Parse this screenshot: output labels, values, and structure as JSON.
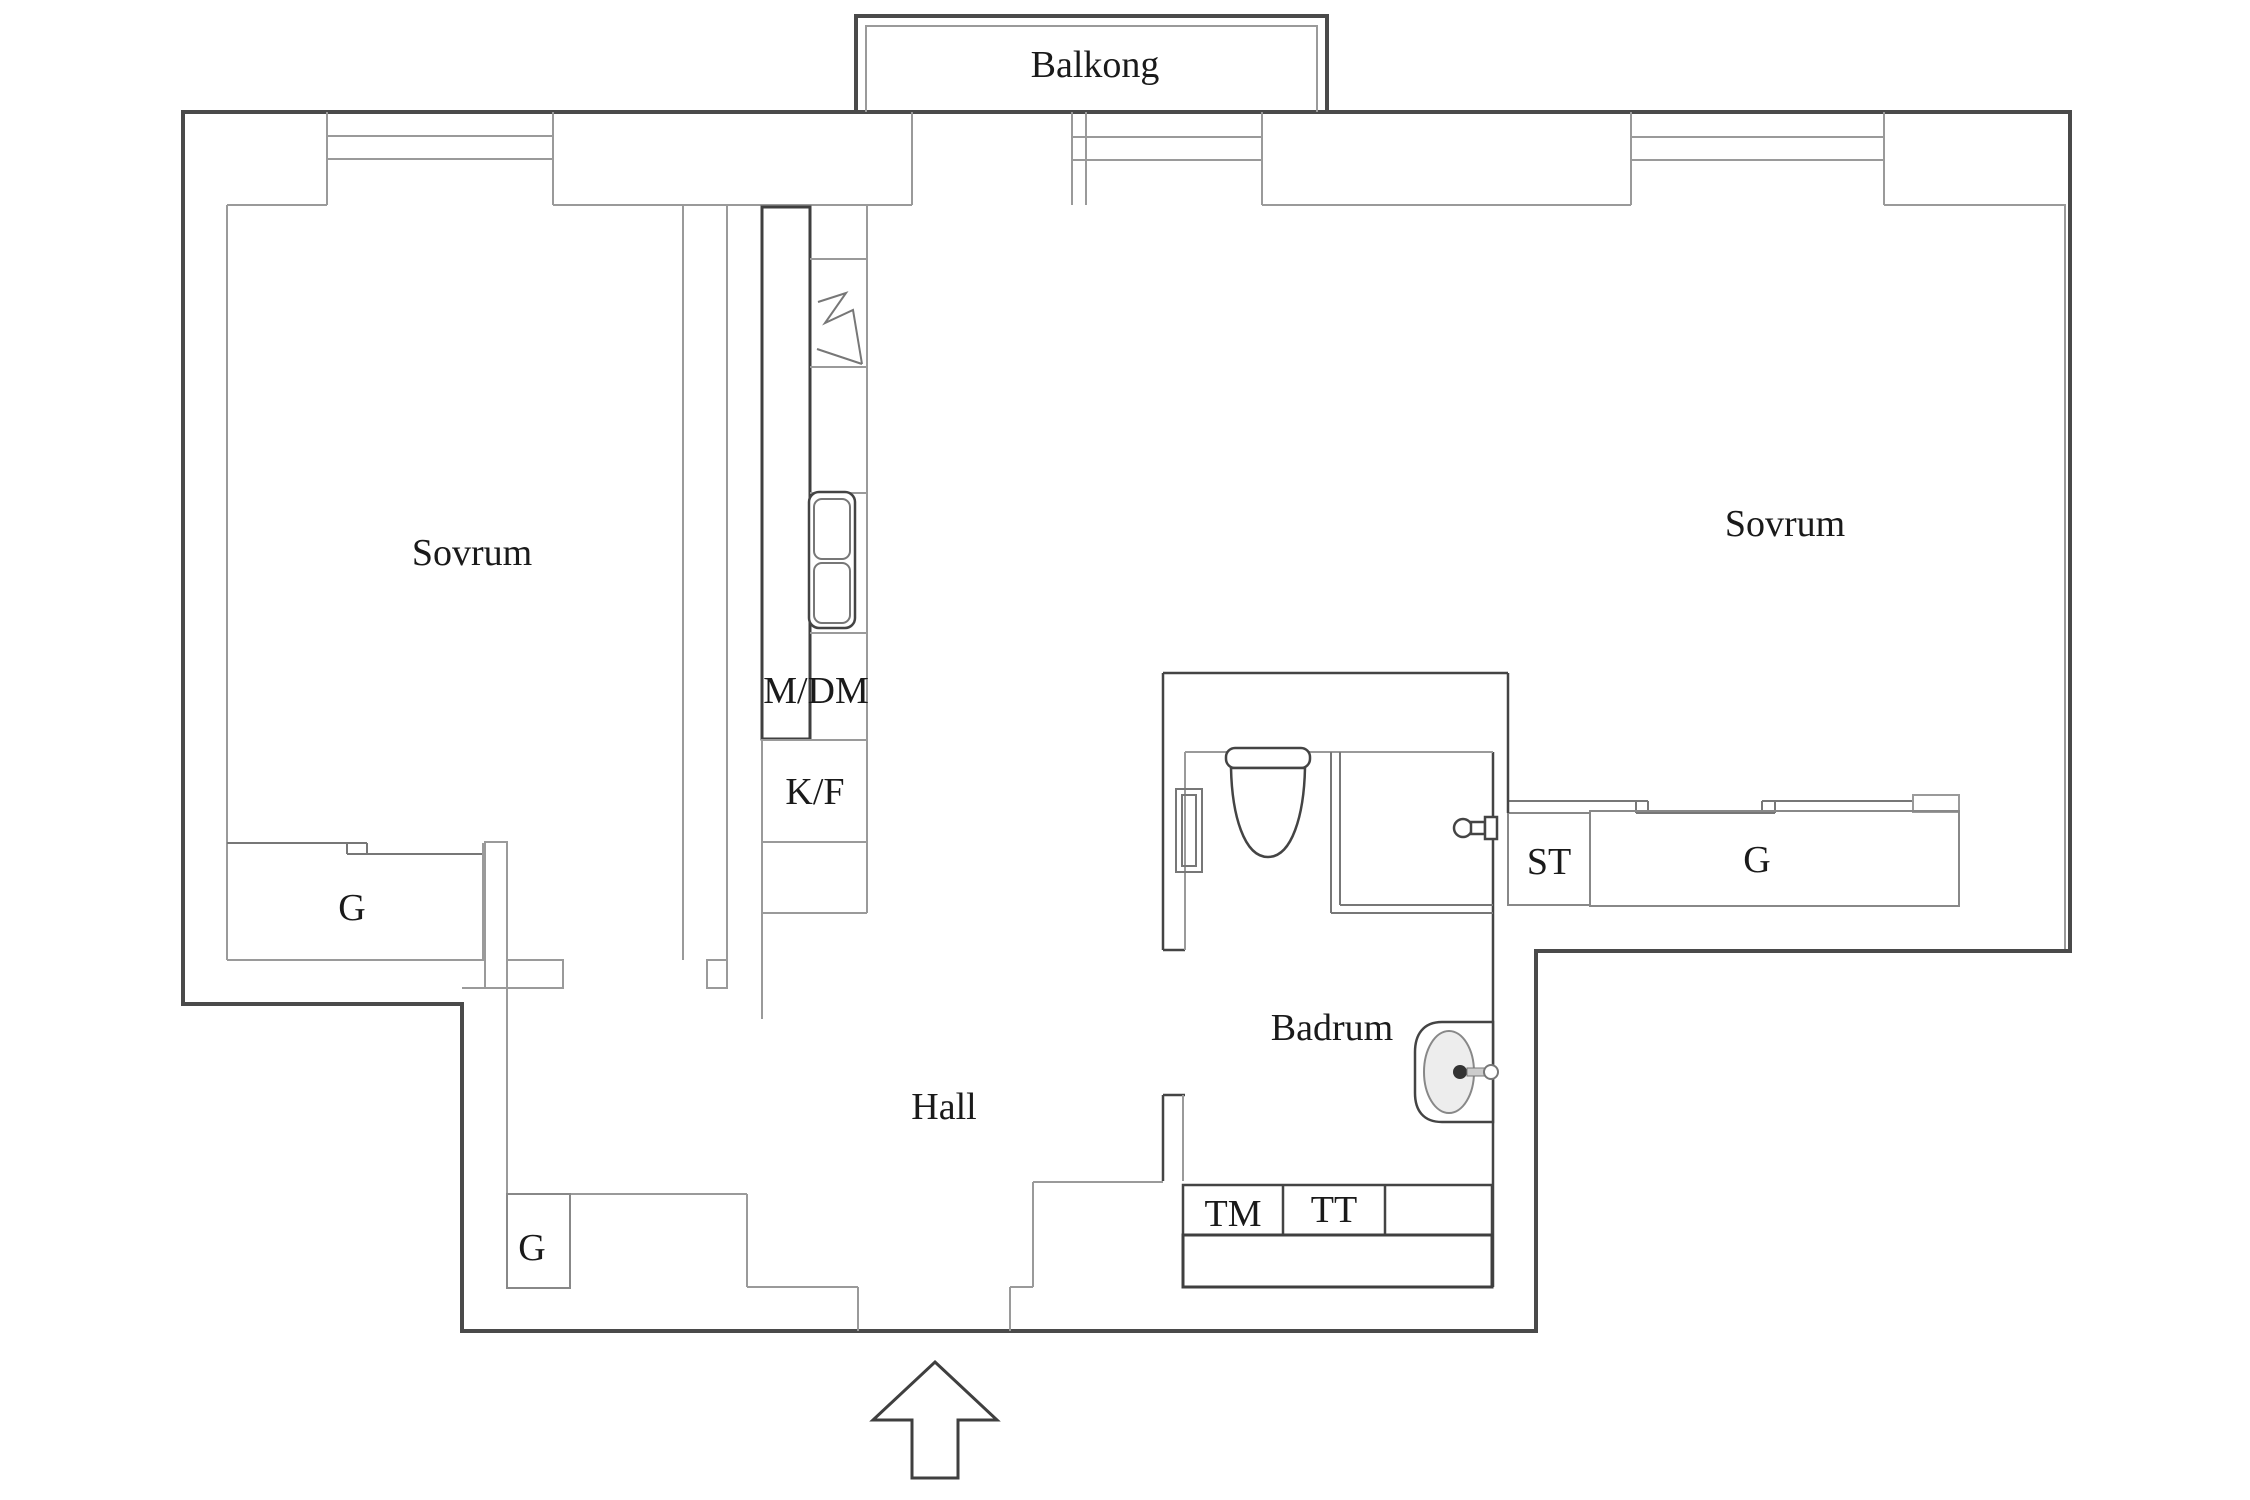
{
  "plan_title": "Apartment floor plan",
  "labels": {
    "balcony": "Balkong",
    "bedroom_left": "Sovrum",
    "bedroom_right": "Sovrum",
    "hall": "Hall",
    "bathroom": "Badrum",
    "wardrobe_bedroom_left": "G",
    "wardrobe_hall": "G",
    "wardrobe_bedroom_right": "G",
    "cleaning_cabinet": "ST",
    "microwave_dishwasher": "M/DM",
    "fridge_freezer": "K/F",
    "washing_machine": "TM",
    "tumble_dryer": "TT"
  },
  "colors": {
    "background": "#ffffff",
    "outer_wall": "#4a4a4a",
    "interior_line": "#9a9a9a",
    "fixture_line": "#444444",
    "text": "#1a1a1a"
  },
  "icons": [
    "entrance-arrow-icon",
    "window-icon",
    "toilet-icon",
    "shower-icon",
    "bathroom-sink-icon",
    "kitchen-sink-icon",
    "stove-icon",
    "radiator-icon",
    "sliding-door-icon"
  ]
}
